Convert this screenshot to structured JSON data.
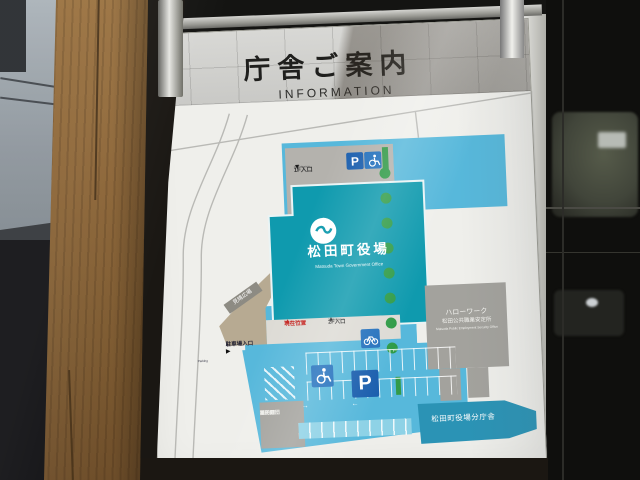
{
  "sign": {
    "title": "庁舎ご案内",
    "subtitle": "INFORMATION"
  },
  "map": {
    "main_building": {
      "name": "松田町役場",
      "name_en": "Matsuda Town Government Office"
    },
    "hellowork_building": {
      "line1": "ハローワーク",
      "line2": "松田公共職業安定所",
      "line3": "Matsuda Public Employment Security Office"
    },
    "branch_building": {
      "name": "松田町役場分庁舎"
    },
    "fire_station": {
      "line1": "松田町",
      "line2": "消防団",
      "line3": "第一分団"
    },
    "plaza": {
      "name": "見晴広場"
    },
    "labels": {
      "entrance_1f": {
        "jp": "1F入口",
        "en": "1F Entrance",
        "arrow": "▼"
      },
      "entrance_2f": {
        "jp": "2F入口",
        "en": "2F Entrance",
        "arrow": "▲"
      },
      "you_are_here": {
        "jp": "現在位置",
        "en": "You are here",
        "arrow": "▲"
      },
      "parking_entrance": {
        "jp": "駐車場入口",
        "en": "Parking",
        "arrow": "▶"
      },
      "lane_arrow_left": "←",
      "lane_arrow_right": "→"
    },
    "icons": {
      "parking_label": "P",
      "wheelchair": "wheelchair-symbol",
      "bicycle": "bicycle-symbol"
    },
    "colors": {
      "site_blue": "#57b8db",
      "building_teal": "#0f9aae",
      "branch_teal": "#2b93b5",
      "building_gray": "#a3a29d",
      "tree_green": "#339a48",
      "parking_sign_blue": "#1b5fae",
      "accessible_blue": "#2471bd",
      "marker_red": "#c4231f"
    }
  }
}
